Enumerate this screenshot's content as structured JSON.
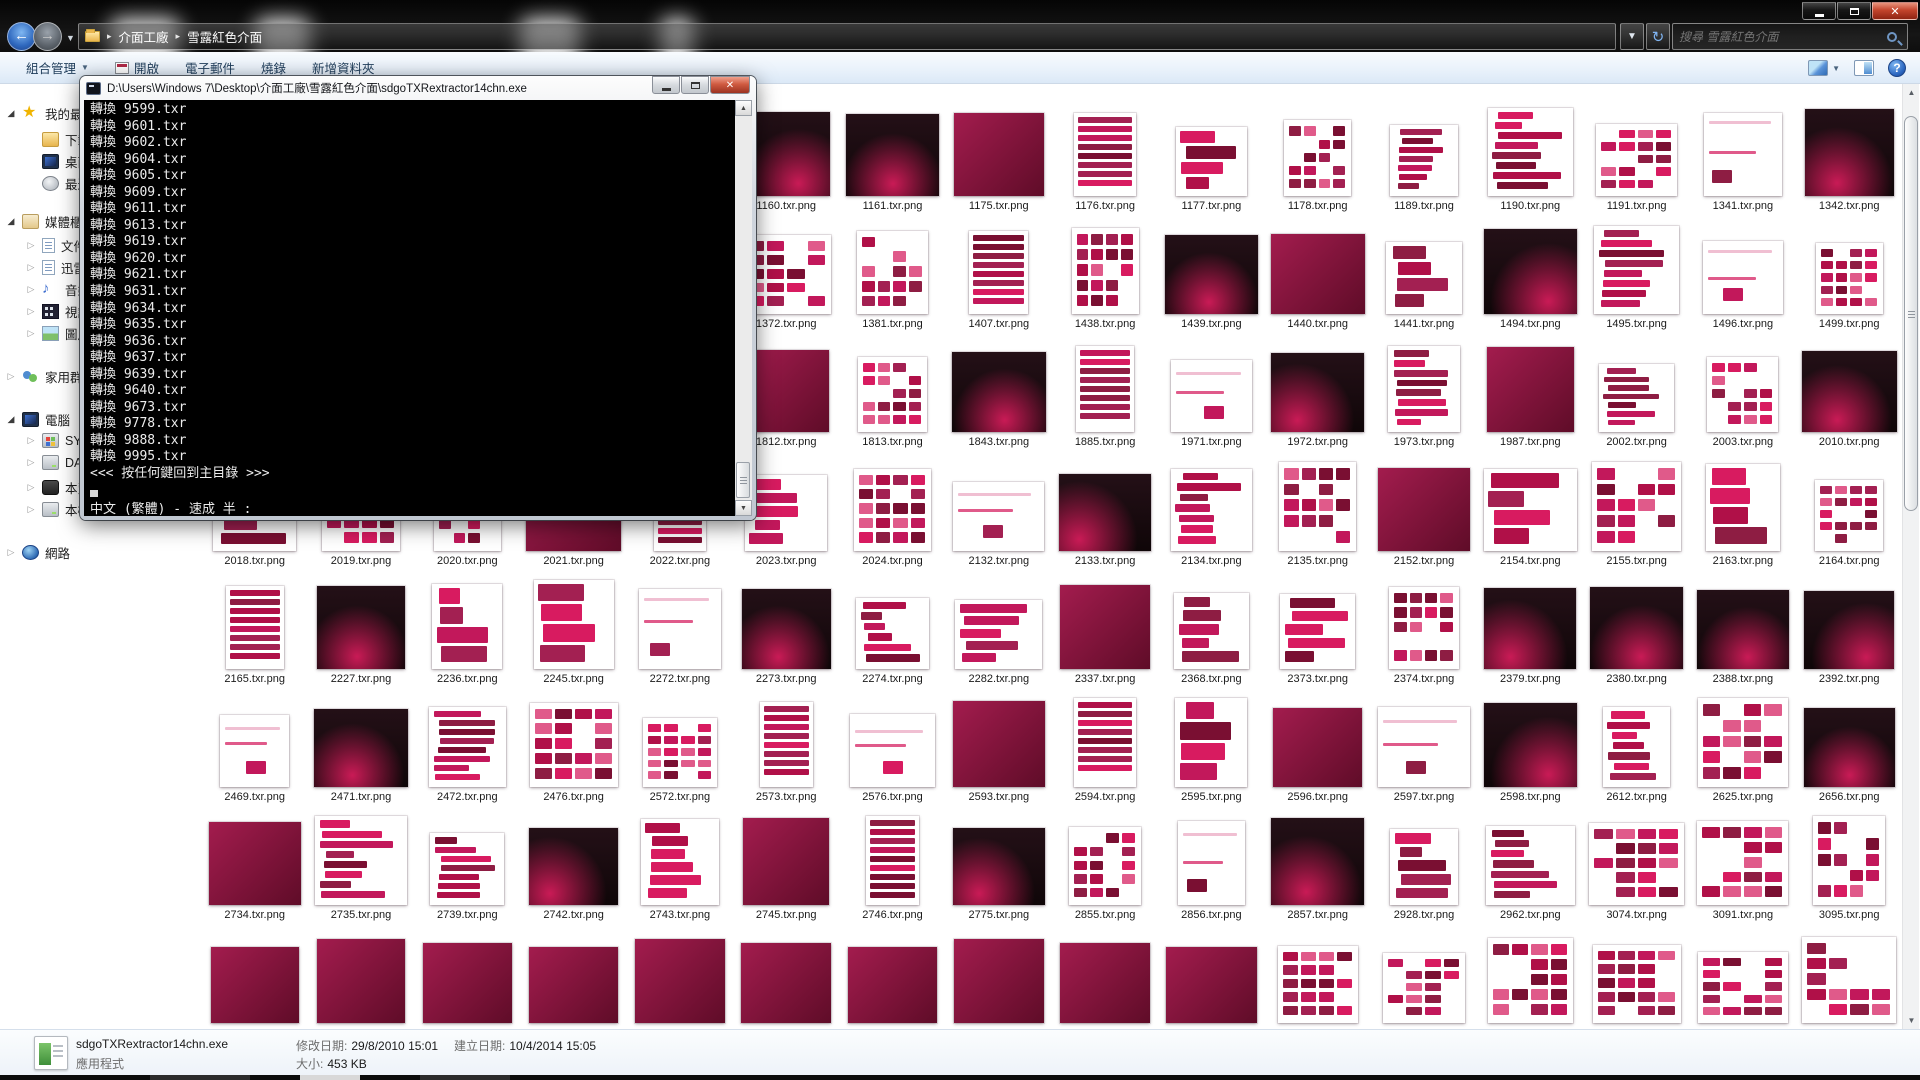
{
  "window": {
    "controls": {
      "minimize": "minimize",
      "maximize": "maximize",
      "close": "close"
    },
    "breadcrumb": {
      "items": [
        "介面工廠",
        "雪露紅色介面"
      ]
    },
    "search": {
      "placeholder": "搜尋 雪露紅色介面"
    },
    "toolbar": {
      "organize": "組合管理",
      "commands": [
        "開啟",
        "電子郵件",
        "燒錄",
        "新增資料夾"
      ],
      "right_icons": [
        "views-icon",
        "preview-pane-icon",
        "help-icon"
      ]
    }
  },
  "sidebar": {
    "items": [
      {
        "label": "我的最愛",
        "icon": "star",
        "arrow": "exp",
        "level": 0
      },
      {
        "label": "下載",
        "icon": "folder",
        "arrow": "",
        "level": 1
      },
      {
        "label": "桌面",
        "icon": "mon",
        "arrow": "",
        "level": 1
      },
      {
        "label": "最近的位置",
        "icon": "clock",
        "arrow": "",
        "level": 1
      },
      {
        "label": "媒體櫃",
        "icon": "shelf",
        "arrow": "exp",
        "level": 0
      },
      {
        "label": "文件",
        "icon": "page",
        "arrow": "col",
        "level": 1
      },
      {
        "label": "迅雷",
        "icon": "page",
        "arrow": "col",
        "level": 1
      },
      {
        "label": "音樂",
        "icon": "note",
        "arrow": "col",
        "level": 1
      },
      {
        "label": "視訊",
        "icon": "film",
        "arrow": "col",
        "level": 1
      },
      {
        "label": "圖片",
        "icon": "pic",
        "arrow": "col",
        "level": 1
      },
      {
        "label": "家用群組",
        "icon": "grp",
        "arrow": "col",
        "level": 0
      },
      {
        "label": "電腦",
        "icon": "mon",
        "arrow": "exp",
        "level": 0
      },
      {
        "label": "SYST",
        "icon": "sysdisk",
        "arrow": "col",
        "level": 1
      },
      {
        "label": "DAT",
        "icon": "disk",
        "arrow": "col",
        "level": 1
      },
      {
        "label": "本爵",
        "icon": "diskdark",
        "arrow": "col",
        "level": 1
      },
      {
        "label": "本機",
        "icon": "disk",
        "arrow": "col",
        "level": 1
      },
      {
        "label": "網路",
        "icon": "net",
        "arrow": "col",
        "level": 0
      }
    ]
  },
  "console": {
    "title": "D:\\Users\\Windows 7\\Desktop\\介面工廠\\雪露紅色介面\\sdgoTXRextractor14chn.exe",
    "lines": [
      "轉換 9599.txr",
      "轉換 9601.txr",
      "轉換 9602.txr",
      "轉換 9604.txr",
      "轉換 9605.txr",
      "轉換 9609.txr",
      "轉換 9611.txr",
      "轉換 9613.txr",
      "轉換 9619.txr",
      "轉換 9620.txr",
      "轉換 9621.txr",
      "轉換 9631.txr",
      "轉換 9634.txr",
      "轉換 9635.txr",
      "轉換 9636.txr",
      "轉換 9637.txr",
      "轉換 9639.txr",
      "轉換 9640.txr",
      "轉換 9673.txr",
      "轉換 9778.txr",
      "轉換 9888.txr",
      "轉換 9995.txr"
    ],
    "prompt_line": "<<< 按任何鍵回到主目錄 >>>",
    "ime_line": "中文 (繁體) - 速成 半 :"
  },
  "grid": {
    "rows": [
      {
        "start_col": 6,
        "files": [
          "1160.txr.png",
          "1161.txr.png",
          "1175.txr.png",
          "1176.txr.png",
          "1177.txr.png",
          "1178.txr.png",
          "1189.txr.png",
          "1190.txr.png",
          "1191.txr.png",
          "1341.txr.png",
          "1342.txr.png"
        ]
      },
      {
        "start_col": 6,
        "files": [
          "1372.txr.png",
          "1381.txr.png",
          "1407.txr.png",
          "1438.txr.png",
          "1439.txr.png",
          "1440.txr.png",
          "1441.txr.png",
          "1494.txr.png",
          "1495.txr.png",
          "1496.txr.png",
          "1499.txr.png"
        ]
      },
      {
        "start_col": 6,
        "files": [
          "1812.txr.png",
          "1813.txr.png",
          "1843.txr.png",
          "1885.txr.png",
          "1971.txr.png",
          "1972.txr.png",
          "1973.txr.png",
          "1987.txr.png",
          "2002.txr.png",
          "2003.txr.png",
          "2010.txr.png"
        ]
      },
      {
        "start_col": 1,
        "files": [
          "2018.txr.png",
          "2019.txr.png",
          "2020.txr.png",
          "2021.txr.png",
          "2022.txr.png",
          "2023.txr.png",
          "2024.txr.png",
          "2132.txr.png",
          "2133.txr.png",
          "2134.txr.png",
          "2135.txr.png",
          "2152.txr.png",
          "2154.txr.png",
          "2155.txr.png",
          "2163.txr.png",
          "2164.txr.png"
        ]
      },
      {
        "start_col": 1,
        "files": [
          "2165.txr.png",
          "2227.txr.png",
          "2236.txr.png",
          "2245.txr.png",
          "2272.txr.png",
          "2273.txr.png",
          "2274.txr.png",
          "2282.txr.png",
          "2337.txr.png",
          "2368.txr.png",
          "2373.txr.png",
          "2374.txr.png",
          "2379.txr.png",
          "2380.txr.png",
          "2388.txr.png",
          "2392.txr.png"
        ]
      },
      {
        "start_col": 1,
        "files": [
          "2469.txr.png",
          "2471.txr.png",
          "2472.txr.png",
          "2476.txr.png",
          "2572.txr.png",
          "2573.txr.png",
          "2576.txr.png",
          "2593.txr.png",
          "2594.txr.png",
          "2595.txr.png",
          "2596.txr.png",
          "2597.txr.png",
          "2598.txr.png",
          "2612.txr.png",
          "2625.txr.png",
          "2656.txr.png"
        ]
      },
      {
        "start_col": 1,
        "files": [
          "2734.txr.png",
          "2735.txr.png",
          "2739.txr.png",
          "2742.txr.png",
          "2743.txr.png",
          "2745.txr.png",
          "2746.txr.png",
          "2775.txr.png",
          "2855.txr.png",
          "2856.txr.png",
          "2857.txr.png",
          "2928.txr.png",
          "2962.txr.png",
          "3074.txr.png",
          "3091.txr.png",
          "3095.txr.png"
        ]
      },
      {
        "start_col": 1,
        "files": [
          "",
          "",
          "",
          "",
          "",
          "",
          "",
          "",
          "",
          "",
          "",
          "",
          "",
          "",
          "",
          ""
        ]
      }
    ],
    "looks": {
      "1161.txr.png": "scene",
      "1843.txr.png": "scene",
      "2010.txr.png": "scene",
      "1175.txr.png": "fill",
      "1812.txr.png": "fill",
      "2596.txr.png": "fill",
      "2734.txr.png": "fill"
    }
  },
  "details": {
    "name": "sdgoTXRextractor14chn.exe",
    "type": "應用程式",
    "modified_label": "修改日期:",
    "modified_value": "29/8/2010 15:01",
    "created_label": "建立日期:",
    "created_value": "10/4/2014 15:05",
    "size_label": "大小:",
    "size_value": "453 KB"
  },
  "colors": {
    "accent_crimson": "#c2185b",
    "dark_crimson": "#7a0f32",
    "toolbar_blue": "#dce9f7"
  }
}
